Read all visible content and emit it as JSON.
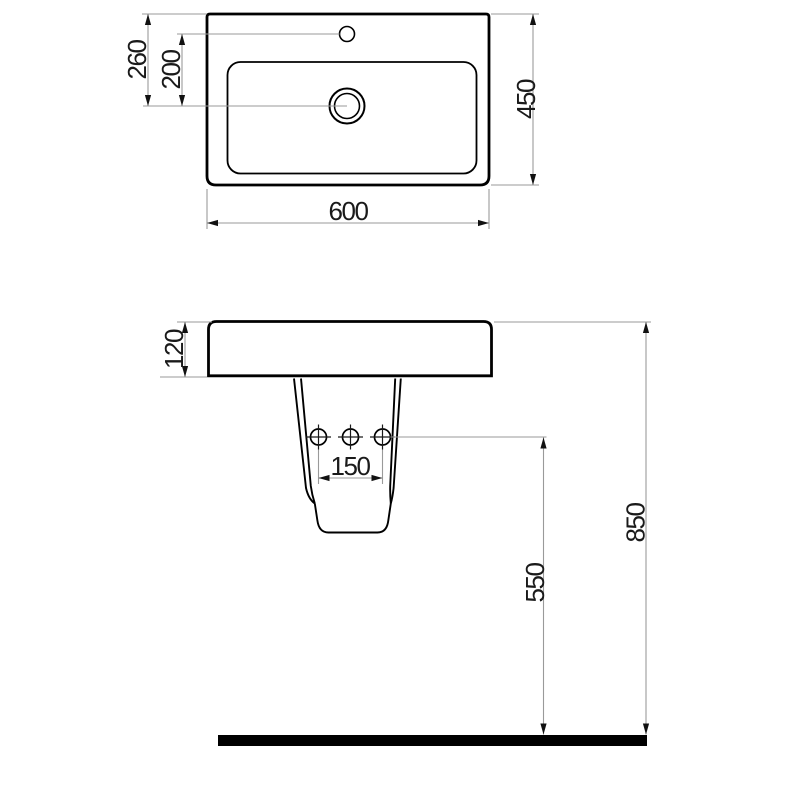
{
  "drawing": {
    "subject": "washbasin-with-semi-pedestal",
    "background_color": "#ffffff",
    "outline_color": "#000000",
    "dimension_line_color": "#9a9a9a",
    "arrow_color": "#111111",
    "label_color": "#1a1a1a",
    "floor_color": "#000000"
  },
  "top_view": {
    "dimensions": {
      "overall_width": "600",
      "overall_depth": "450",
      "back_edge_to_drain": "260",
      "faucet_to_drain": "200"
    }
  },
  "front_view": {
    "dimensions": {
      "basin_height": "120",
      "mounting_hole_spacing": "150",
      "holes_to_floor": "550",
      "overall_height": "850"
    }
  }
}
